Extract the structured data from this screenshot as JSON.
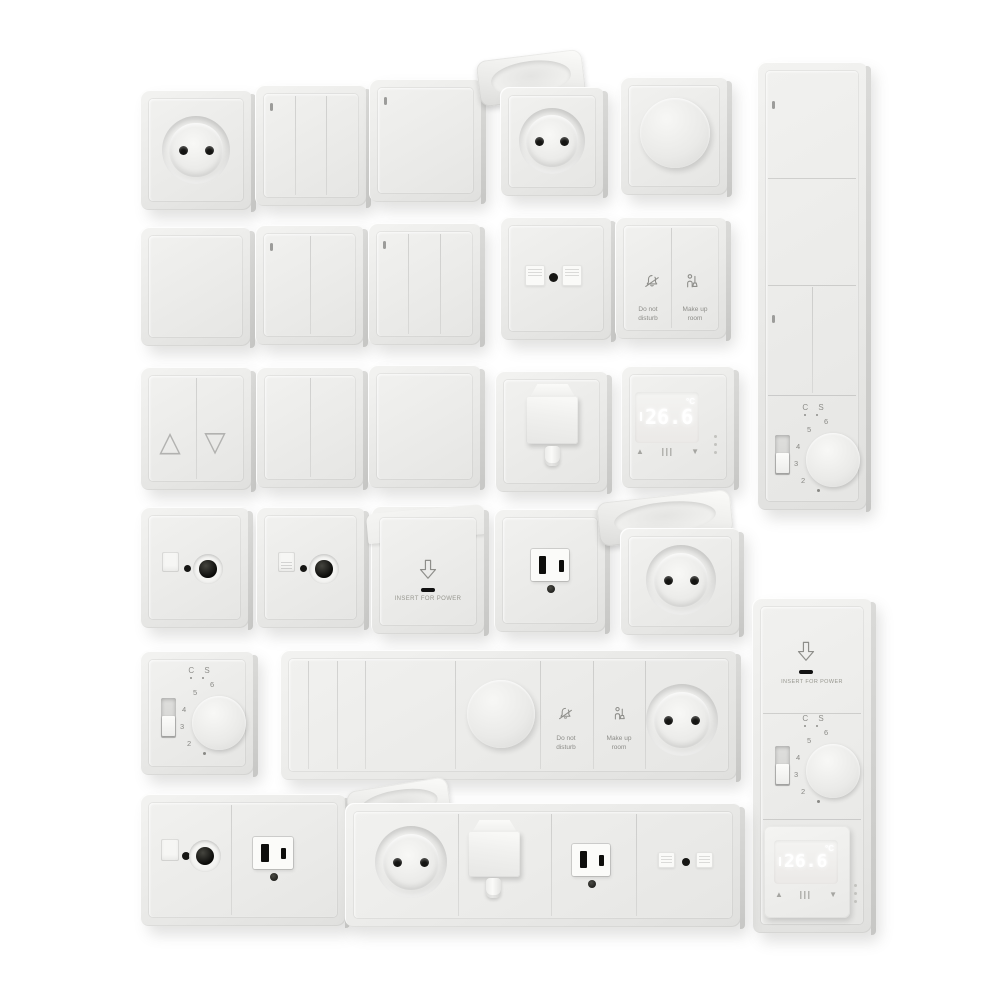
{
  "scene": {
    "description": "3D product render: set of white electrical wall fixtures (switches, sockets, dimmers, thermostats, key-card holders) on a white background",
    "background": "#ffffff"
  },
  "colors": {
    "plate": "#e9e9e7",
    "plate_highlight": "#f5f5f3",
    "plate_edge": "#c7c7c5",
    "contact_black": "#141412",
    "print_gray": "#8e8e8a",
    "display_digits": "#ffffff"
  },
  "labels": {
    "insert_for_power": "INSERT FOR POWER",
    "do_not_disturb": [
      "Do not",
      "disturb"
    ],
    "make_up_room": [
      "Make up",
      "room"
    ],
    "thermostat_display": {
      "temperature": "26.6",
      "unit": "°C",
      "up_button": "▲",
      "down_button": "▼"
    },
    "rotary_dial": {
      "header": "C S",
      "numbers": [
        "2",
        "3",
        "4",
        "5",
        "6"
      ]
    },
    "shutter_switch": {
      "up": "△",
      "down": "▽"
    }
  },
  "fixtures": {
    "row_1": [
      "schuko-socket",
      "switch-3-gang",
      "switch-1-gang",
      "schuko-socket-hinged-lid",
      "rotary-dimmer"
    ],
    "row_2": [
      "push-plate-blank",
      "switch-2-gang",
      "switch-3-gang",
      "data-outlet-2-port",
      "hotel-service-buttons"
    ],
    "row_3": [
      "shutter-switch",
      "switch-2-gang",
      "switch-1-gang",
      "cable-outlet",
      "digital-thermostat"
    ],
    "right_column_1": [
      "switch-1-gang",
      "switch-1-gang",
      "switch-2-gang",
      "rotary-thermostat"
    ],
    "row_4": [
      "tv-sat-outlet",
      "tv-sat-outlet",
      "key-card-holder",
      "us-outlet",
      "schuko-socket-hinged-lid"
    ],
    "row_5": [
      "rotary-thermostat",
      "multi-gang-panel: switches, dimmer, service buttons, schuko socket"
    ],
    "right_column_2": [
      "key-card-holder",
      "rotary-thermostat",
      "digital-thermostat"
    ],
    "row_6": [
      "combo: tv-sat + us-outlet",
      "multi-gang-panel: schuko hinged, cable outlet, us outlet, data outlet"
    ]
  }
}
